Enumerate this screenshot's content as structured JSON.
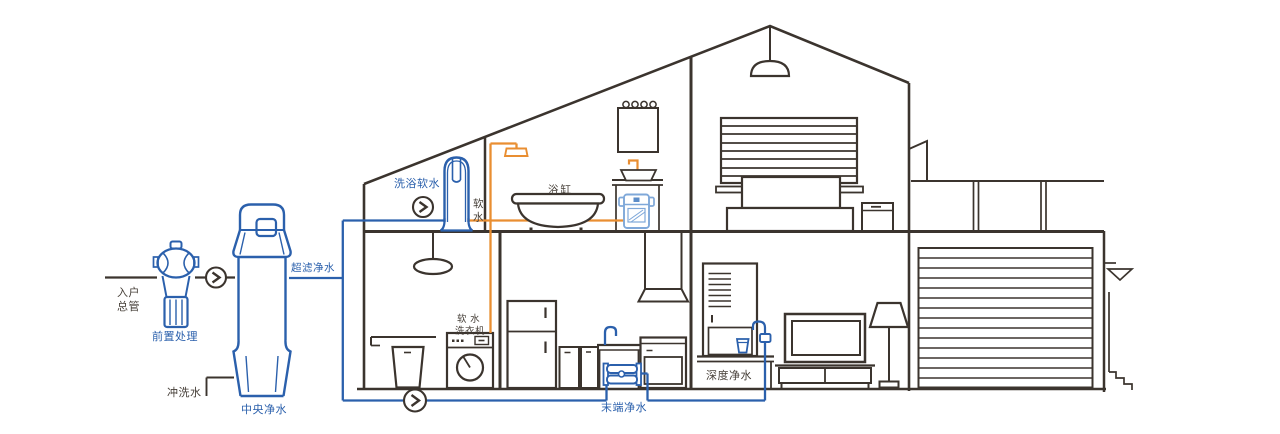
{
  "diagram": {
    "kind": "whole-house water purification system cutaway schematic",
    "background": "#ffffff",
    "colors": {
      "line_dark": "#3b342e",
      "label_dark": "#453e37",
      "equipment_blue": "#2b60ac",
      "soft_water_orange": "#e98e31",
      "light_blue_device": "#7fa8d9"
    },
    "labels": {
      "inlet_main": [
        "入户",
        "总管"
      ],
      "pre_treatment": "前置处理",
      "central_purifier": "中央净水",
      "flush_water": "冲洗水",
      "ultra_filtration": "超滤净水",
      "bath_soft_water": "洗浴软水",
      "soft_water_vertical": [
        "软",
        "水"
      ],
      "bathtub": "浴缸",
      "soft_water_washer_line1": "软 水",
      "soft_water_washer_line2": "洗衣机",
      "terminal_purifier": "末端净水",
      "deep_purifier": "深度净水"
    },
    "equipment": [
      "pre-filter",
      "central-water-purifier",
      "water-softener",
      "under-sink-soft-water-purifier",
      "terminal-ro-filter",
      "deep-purification-dispenser"
    ],
    "fixtures": [
      "shower",
      "bathtub",
      "vanity-sink",
      "mirror",
      "washing-machine",
      "laundry-sink",
      "refrigerator",
      "kitchen-sink",
      "range",
      "range-hood",
      "tv",
      "floor-lamp",
      "bed",
      "nightstand",
      "window-blinds",
      "pendant-lamp",
      "garage-roller-door"
    ],
    "flow_indicators": {
      "count": 3,
      "symbol": "chevron-right-in-circle"
    }
  }
}
